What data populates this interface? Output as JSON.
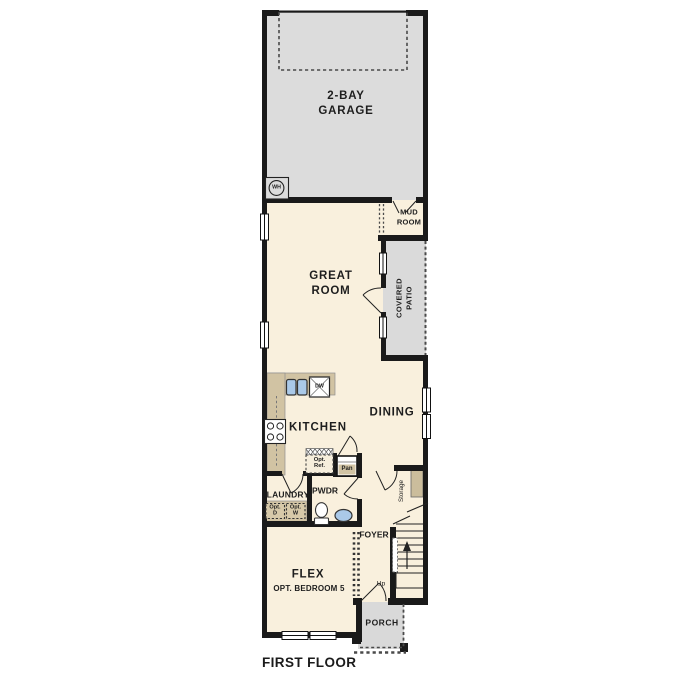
{
  "colors": {
    "wall": "#1a1a1a",
    "garage_fill": "#dcdcdc",
    "patio_fill": "#dadada",
    "porch_fill": "#d9d9d9",
    "interior_fill": "#f9f0dd",
    "counter_fill": "#d1c3a3",
    "fixture_blue": "#aac9e8",
    "label_text": "#1e1e1e"
  },
  "rooms": {
    "garage": {
      "line1": "2-BAY",
      "line2": "GARAGE"
    },
    "great_room": {
      "line1": "GREAT",
      "line2": "ROOM"
    },
    "mud_room": {
      "line1": "MUD",
      "line2": "ROOM"
    },
    "covered_patio": {
      "line1": "COVERED",
      "line2": "PATIO"
    },
    "kitchen": {
      "label": "KITCHEN"
    },
    "dining": {
      "label": "DINING"
    },
    "laundry": {
      "label": "LAUNDRY"
    },
    "powder": {
      "label": "PWDR"
    },
    "foyer": {
      "label": "FOYER"
    },
    "storage": {
      "label": "Storage"
    },
    "flex": {
      "line1": "FLEX",
      "line2": "OPT. BEDROOM 5"
    },
    "porch": {
      "label": "PORCH"
    }
  },
  "fixtures": {
    "water_heater": "WH",
    "dishwasher": "DW",
    "pantry": "Pan",
    "opt_ref": {
      "line1": "Opt.",
      "line2": "Ref."
    },
    "opt_dryer": {
      "line1": "Opt.",
      "line2": "D"
    },
    "opt_washer": {
      "line1": "Opt.",
      "line2": "W"
    },
    "stairs_up": "Up"
  },
  "caption": "FIRST FLOOR"
}
